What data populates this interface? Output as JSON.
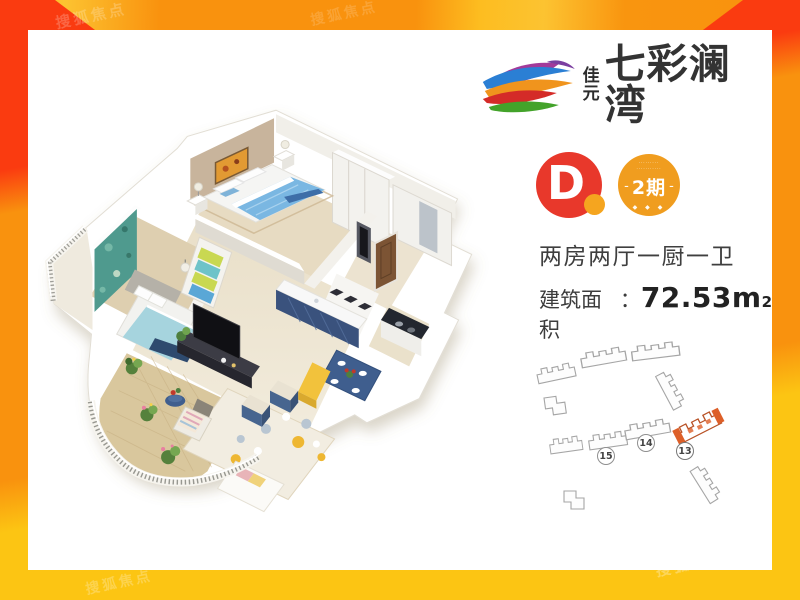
{
  "watermark": {
    "text": "搜狐焦点"
  },
  "brand": {
    "prefix_top": "佳",
    "prefix_bottom": "元",
    "name": "七彩澜湾"
  },
  "unit_badge": {
    "letter": "D"
  },
  "phase_badge": {
    "dots_line1": "·········",
    "dots_line2": "···········",
    "dash_left": "-",
    "label": "2期",
    "dash_right": "-",
    "bottom_dots": "◆ ◆ ◆"
  },
  "specs": {
    "layout": "两房两厅一厨一卫",
    "area_label": "建筑面积",
    "colon": "：",
    "area_value": "72.53m",
    "area_sup": "2"
  },
  "site_map": {
    "buildings": [
      {
        "number": "13",
        "highlighted": true
      },
      {
        "number": "14",
        "highlighted": false
      },
      {
        "number": "15",
        "highlighted": false
      }
    ]
  },
  "colors": {
    "badge_red": "#e8382b",
    "badge_orange": "#f09d1f",
    "accent_orange": "#f5a51f",
    "border_red": "#fa3b10",
    "border_orange": "#f9920e",
    "border_yellow": "#fcc513",
    "highlighted_building": "#dd5f28"
  }
}
